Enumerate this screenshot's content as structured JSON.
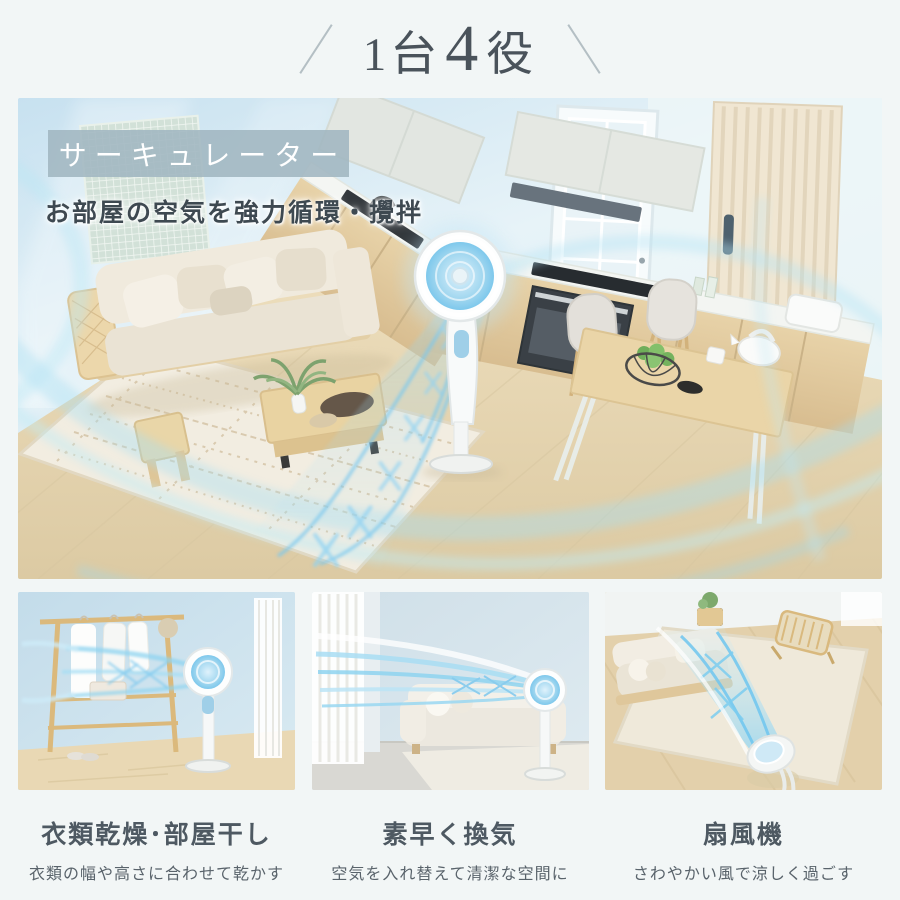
{
  "colors": {
    "page_background": "#f2f6f6",
    "title_text": "#4a535b",
    "badge_background": "#a0b6c0",
    "badge_text": "#ffffff",
    "airflow_blue": "#7fcdf0",
    "wall_blue": "#d9ecf4",
    "wood_floor": "#e6d5b2"
  },
  "header": {
    "title": {
      "prefix": "1台",
      "number": "4",
      "suffix": "役"
    }
  },
  "hero": {
    "badge": "サーキュレーター",
    "subtitle": "お部屋の空気を強力循環・攪拌",
    "scene": "living-dining-kitchen-room-with-pedestal-circulator-blowing-spiral-airflow"
  },
  "features": [
    {
      "title": "衣類乾燥･部屋干し",
      "caption": "衣類の幅や高さに合わせて乾かす",
      "scene": "laundry-rack-with-hanging-clothes-dried-by-circulator"
    },
    {
      "title": "素早く換気",
      "caption": "空気を入れ替えて清潔な空間に",
      "scene": "circulator-blowing-air-toward-window-for-ventilation"
    },
    {
      "title": "扇風機",
      "caption": "さわやかい風で涼しく過ごす",
      "scene": "circulator-as-electric-fan-cooling-living-room"
    }
  ]
}
